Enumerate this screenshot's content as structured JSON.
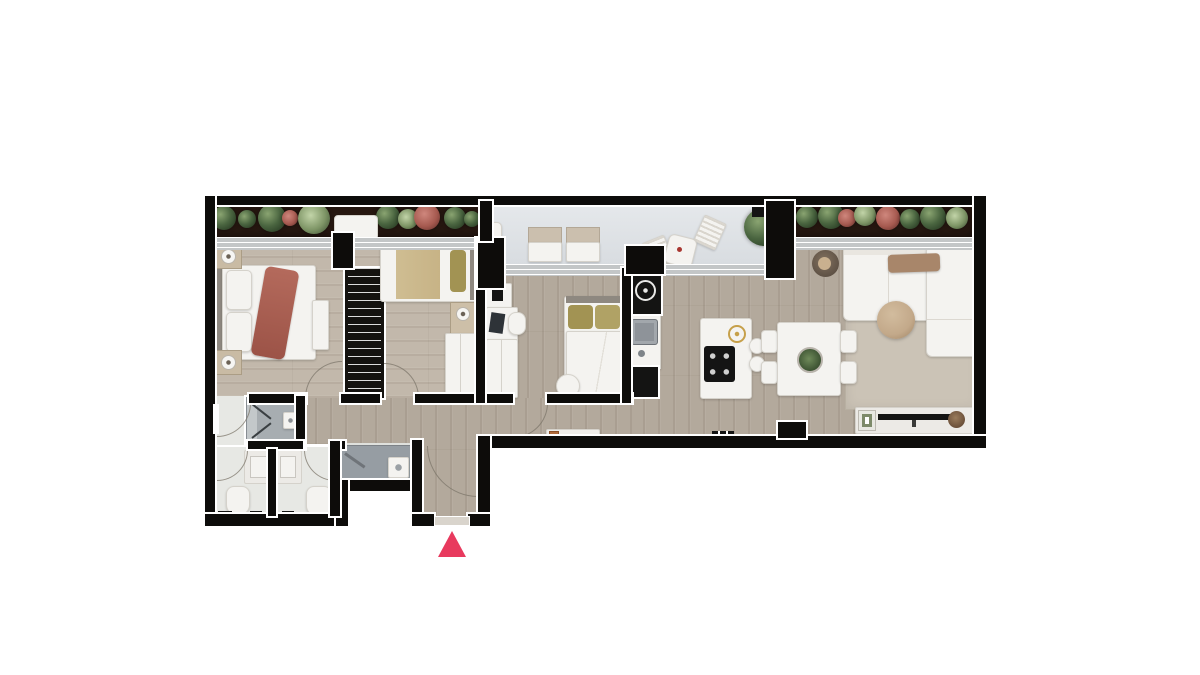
{
  "scene": {
    "description_name": "apartment-floor-plan-top-view",
    "background": "#ffffff"
  },
  "marker": {
    "name": "entrance-marker",
    "shape": "triangle-up",
    "color": "#e83a5e"
  },
  "icons": {
    "entrance_marker": "triangle-up",
    "cooktop": "ring",
    "induction_hob": "four-dots",
    "shower_glass": "chevron"
  },
  "colors": {
    "wall": "#0d0c0a",
    "woodMain": "#b3a99c",
    "woodBedroom": "#c2b8ab",
    "bathFloor": "#e7e8e4",
    "laundryFloor": "#dfe1dd",
    "showerGray": "#a7adb1",
    "counterGray": "#969da3",
    "planterSoil": "#271811",
    "plantGreen": "#4a6540",
    "plantGreenLight": "#8aa471",
    "plantRed": "#a65a50",
    "linen": "#f4f3f0",
    "furnitureBorder": "#d5d2cb",
    "throwRust": "#a95e51",
    "blanketTan": "#c7b386",
    "pillowOlive": "#a29353",
    "headboardGray": "#8e8880",
    "rugBeige": "#cbc3b6",
    "ottomanTan": "#c3a98a",
    "trayWood": "#a8866a",
    "gold": "#c6a04a",
    "applianceGray": "#8e9399",
    "sillGray": "#c3c6c7",
    "tvBlack": "#141413",
    "marker": "#e83a5e"
  }
}
